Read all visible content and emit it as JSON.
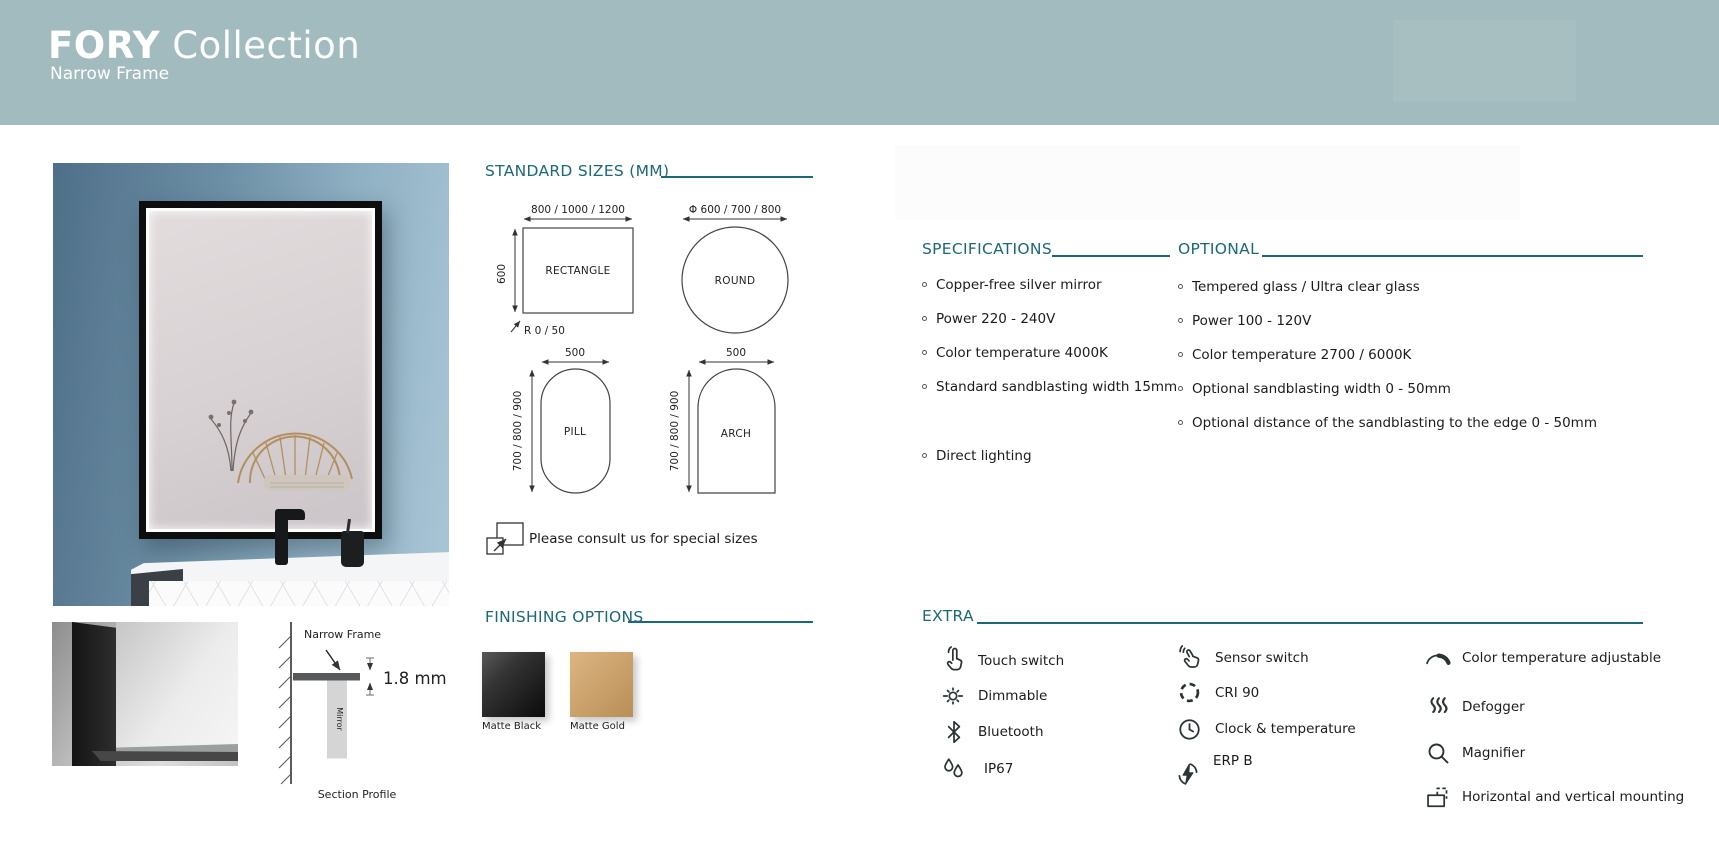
{
  "header": {
    "brand_bold": "FORY",
    "brand_light": " Collection",
    "subtitle": "Narrow Frame"
  },
  "standard_sizes": {
    "title": "STANDARD SIZES (MM)",
    "rectangle": {
      "name": "RECTANGLE",
      "width_label": "800 / 1000 / 1200",
      "height_label": "600",
      "corner_label": "R 0 / 50"
    },
    "round": {
      "name": "ROUND",
      "width_label": "Φ 600 / 700 / 800"
    },
    "pill": {
      "name": "PILL",
      "width_label": "500",
      "height_label": "700 / 800 / 900"
    },
    "arch": {
      "name": "ARCH",
      "width_label": "500",
      "height_label": "700 / 800 / 900"
    },
    "note": "Please consult us for special sizes"
  },
  "finishing": {
    "title": "FINISHING OPTIONS",
    "options": [
      {
        "label": "Matte Black",
        "color": "#1a1a1a"
      },
      {
        "label": "Matte Gold",
        "color": "#c9a06a"
      }
    ]
  },
  "specifications": {
    "title": "SPECIFICATIONS",
    "items": [
      "Copper-free silver mirror",
      "Power 220 - 240V",
      "Color temperature 4000K",
      "Standard sandblasting width 15mm",
      "Direct lighting"
    ]
  },
  "optional": {
    "title": "OPTIONAL",
    "items": [
      "Tempered glass / Ultra clear glass",
      "Power 100 - 120V",
      "Color temperature 2700 / 6000K",
      "Optional sandblasting width 0 - 50mm",
      "Optional distance of the sandblasting to the edge 0 - 50mm"
    ]
  },
  "extra": {
    "title": "EXTRA",
    "features": [
      {
        "label": "Touch switch",
        "icon": "touch-icon"
      },
      {
        "label": "Dimmable",
        "icon": "brightness-icon"
      },
      {
        "label": "Bluetooth",
        "icon": "bluetooth-icon"
      },
      {
        "label": "IP67",
        "icon": "water-drops-icon"
      },
      {
        "label": "Sensor switch",
        "icon": "sensor-hand-icon"
      },
      {
        "label": "CRI 90",
        "icon": "dashed-circle-icon"
      },
      {
        "label": "Clock & temperature",
        "icon": "clock-icon"
      },
      {
        "label": "ERP B",
        "icon": "energy-bolt-icon"
      },
      {
        "label": "Color temperature adjustable",
        "icon": "arc-dial-icon"
      },
      {
        "label": "Defogger",
        "icon": "heat-waves-icon"
      },
      {
        "label": "Magnifier",
        "icon": "magnifier-icon"
      },
      {
        "label": "Horizontal and vertical mounting",
        "icon": "mounting-icon"
      }
    ]
  },
  "profile_diagram": {
    "frame_label": "Narrow Frame",
    "mirror_label": "Mirror",
    "thickness": "1.8 mm",
    "caption": "Section Profile"
  },
  "colors": {
    "header_bg": "#a2bbbe",
    "accent_teal": "#1b6876",
    "matte_black": "#1a1a1a",
    "matte_gold": "#c9a06a"
  }
}
